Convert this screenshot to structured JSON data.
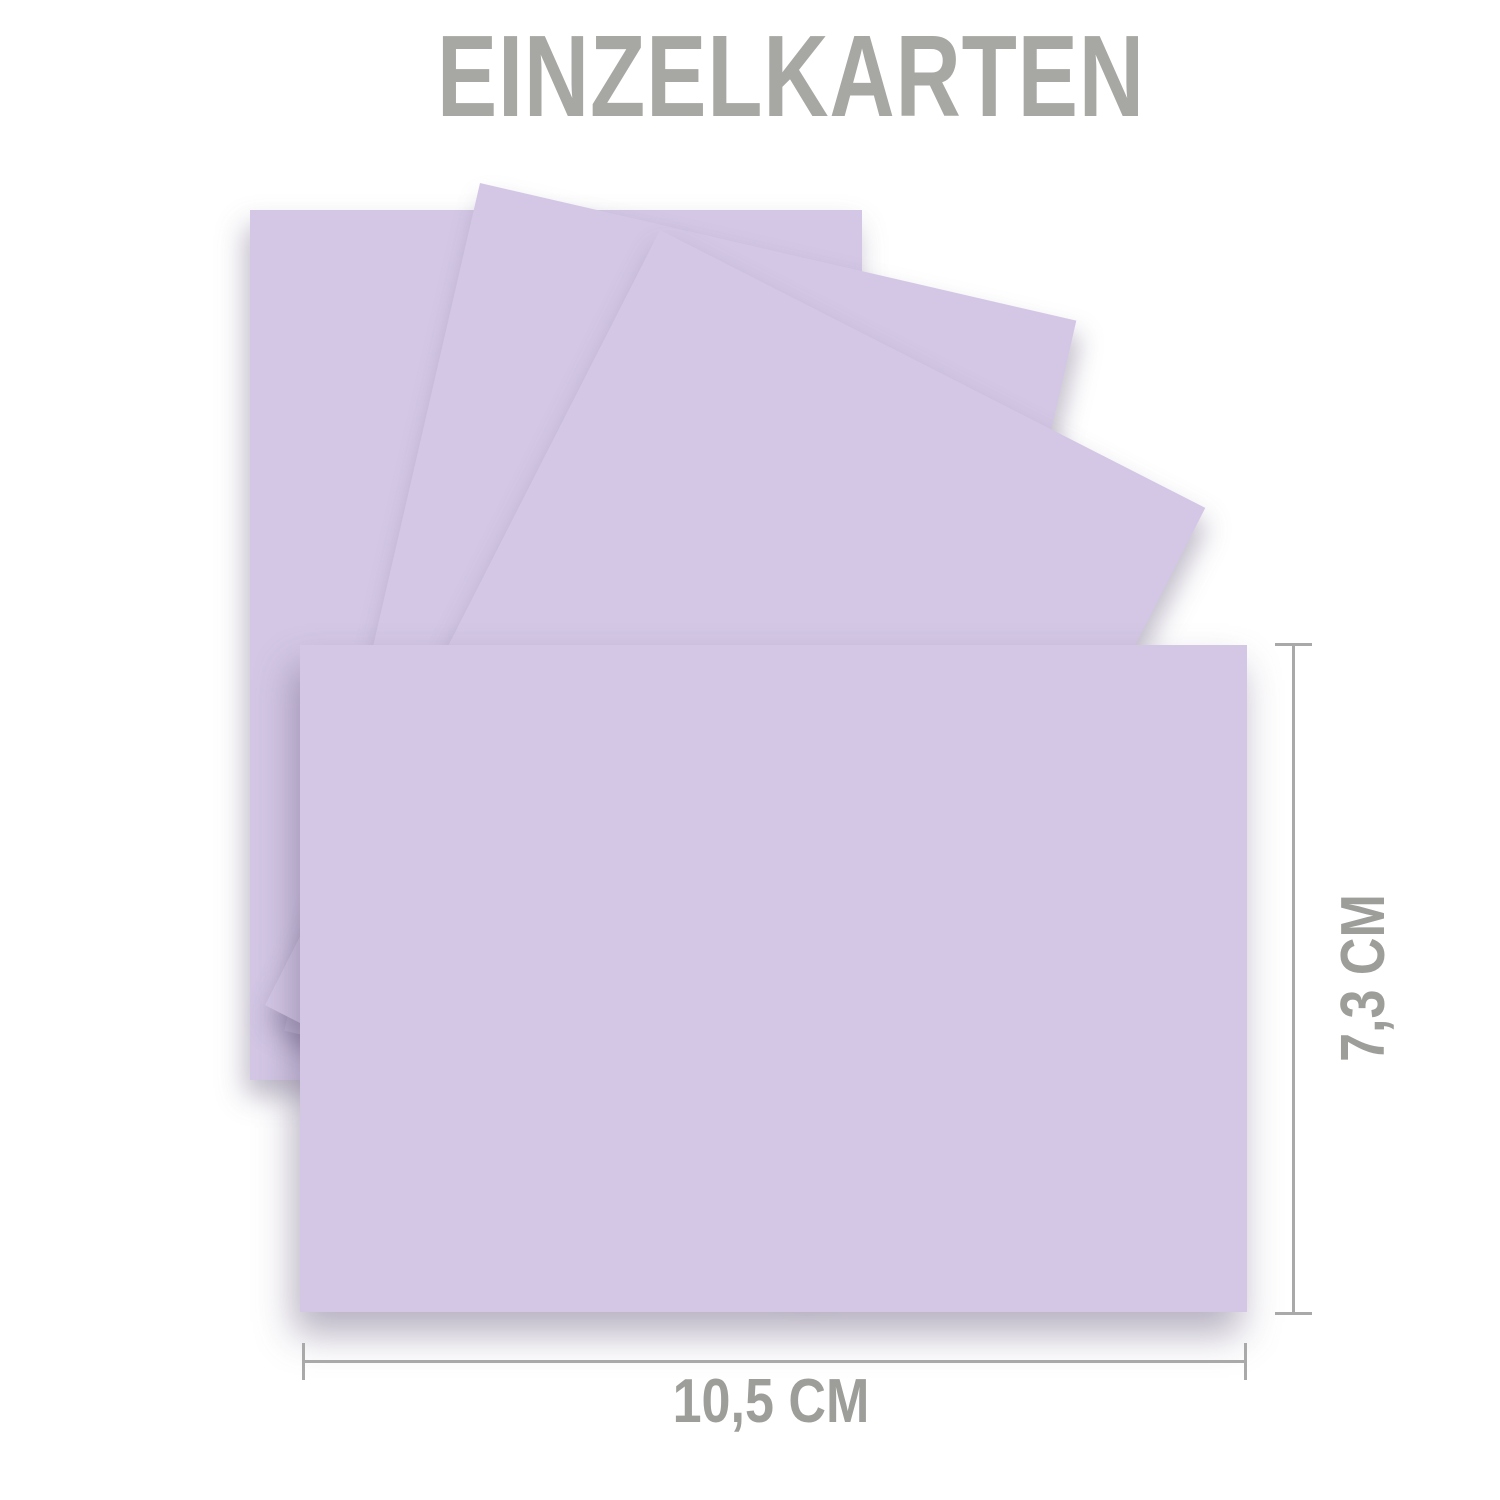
{
  "title": {
    "text": "EINZELKARTEN"
  },
  "cards": {
    "visible_count": 4,
    "stacked_portrait_cards": 3,
    "front_landscape_cards": 1
  },
  "dimensions": {
    "height_label": "7,3 CM",
    "width_label": "10,5 CM"
  },
  "colors": {
    "background": "#FFFFFF",
    "card_lilac": "#D3C7E5",
    "title_text": "#A7A7A3",
    "dimension_text": "#9D9D99",
    "dimension_line": "#A9A9A9"
  }
}
